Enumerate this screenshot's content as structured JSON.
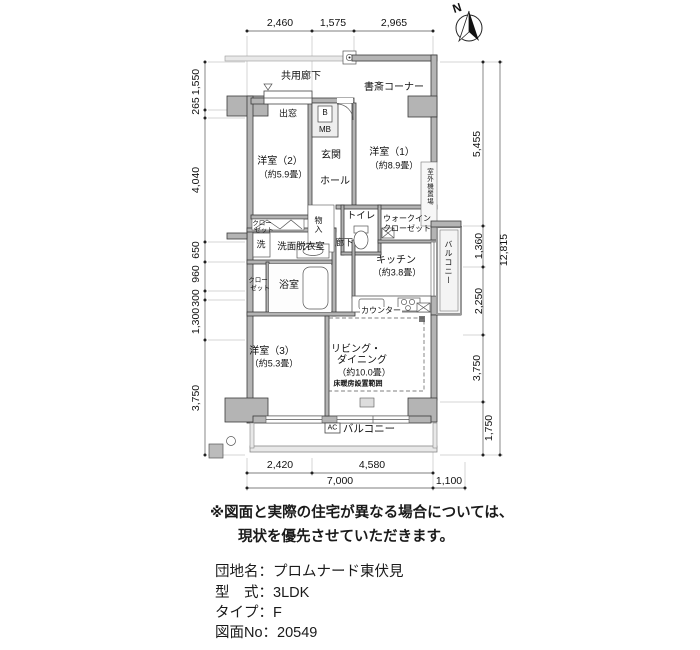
{
  "compass": {
    "label": "N"
  },
  "dimensions": {
    "top": [
      "2,460",
      "1,575",
      "2,965"
    ],
    "left": [
      "1,550",
      "265",
      "4,040",
      "650",
      "960",
      "300",
      "1,300",
      "3,750"
    ],
    "right": [
      "5,455",
      "1,360",
      "2,250",
      "3,750",
      "1,750"
    ],
    "right_total": "12,815",
    "bottom": [
      "2,420",
      "4,580"
    ],
    "bottom_total": "7,000",
    "bottom_right": "1,100"
  },
  "labels": {
    "common_corridor": "共用廊下",
    "study_corner": "書斎コーナー",
    "bay_window": "出窓",
    "meter_box_b": "B",
    "meter_box": "MB",
    "entrance": "玄関",
    "hall": "ホール",
    "room1": "洋室（1）",
    "room1_size": "（約8.9畳）",
    "room2": "洋室（2）",
    "room2_size": "（約5.9畳）",
    "room3": "洋室（3）",
    "room3_size": "（約5.3畳）",
    "living1": "リビング・",
    "living2": "ダイニング",
    "living_size": "（約10.0畳）",
    "floor_heating": "床暖房設置範囲",
    "kitchen": "キッチン",
    "kitchen_size": "（約3.8畳）",
    "counter": "カウンター",
    "toilet": "トイレ",
    "wic1": "ウォークイン",
    "wic2": "クローゼット",
    "washroom": "洗面脱衣室",
    "washer": "洗",
    "bathroom": "浴室",
    "closet_a1": "クロー",
    "closet_a2": "ゼット",
    "closet_b1": "クロー",
    "closet_b2": "ゼット",
    "storage": "物入",
    "corridor": "廊下",
    "outdoor_unit": "室外機置場",
    "balcony_side": "バルコニー",
    "balcony_ac": "AC",
    "balcony_bottom": "バルコニー"
  },
  "notes": {
    "line1": "※図面と実際の住宅が異なる場合については、",
    "line2": "現状を優先させていただきます。"
  },
  "title_block": {
    "lines": [
      "団地名：プロムナード東伏見",
      "型　式：3LDK",
      "タイプ：F",
      "図面No：20549"
    ]
  }
}
